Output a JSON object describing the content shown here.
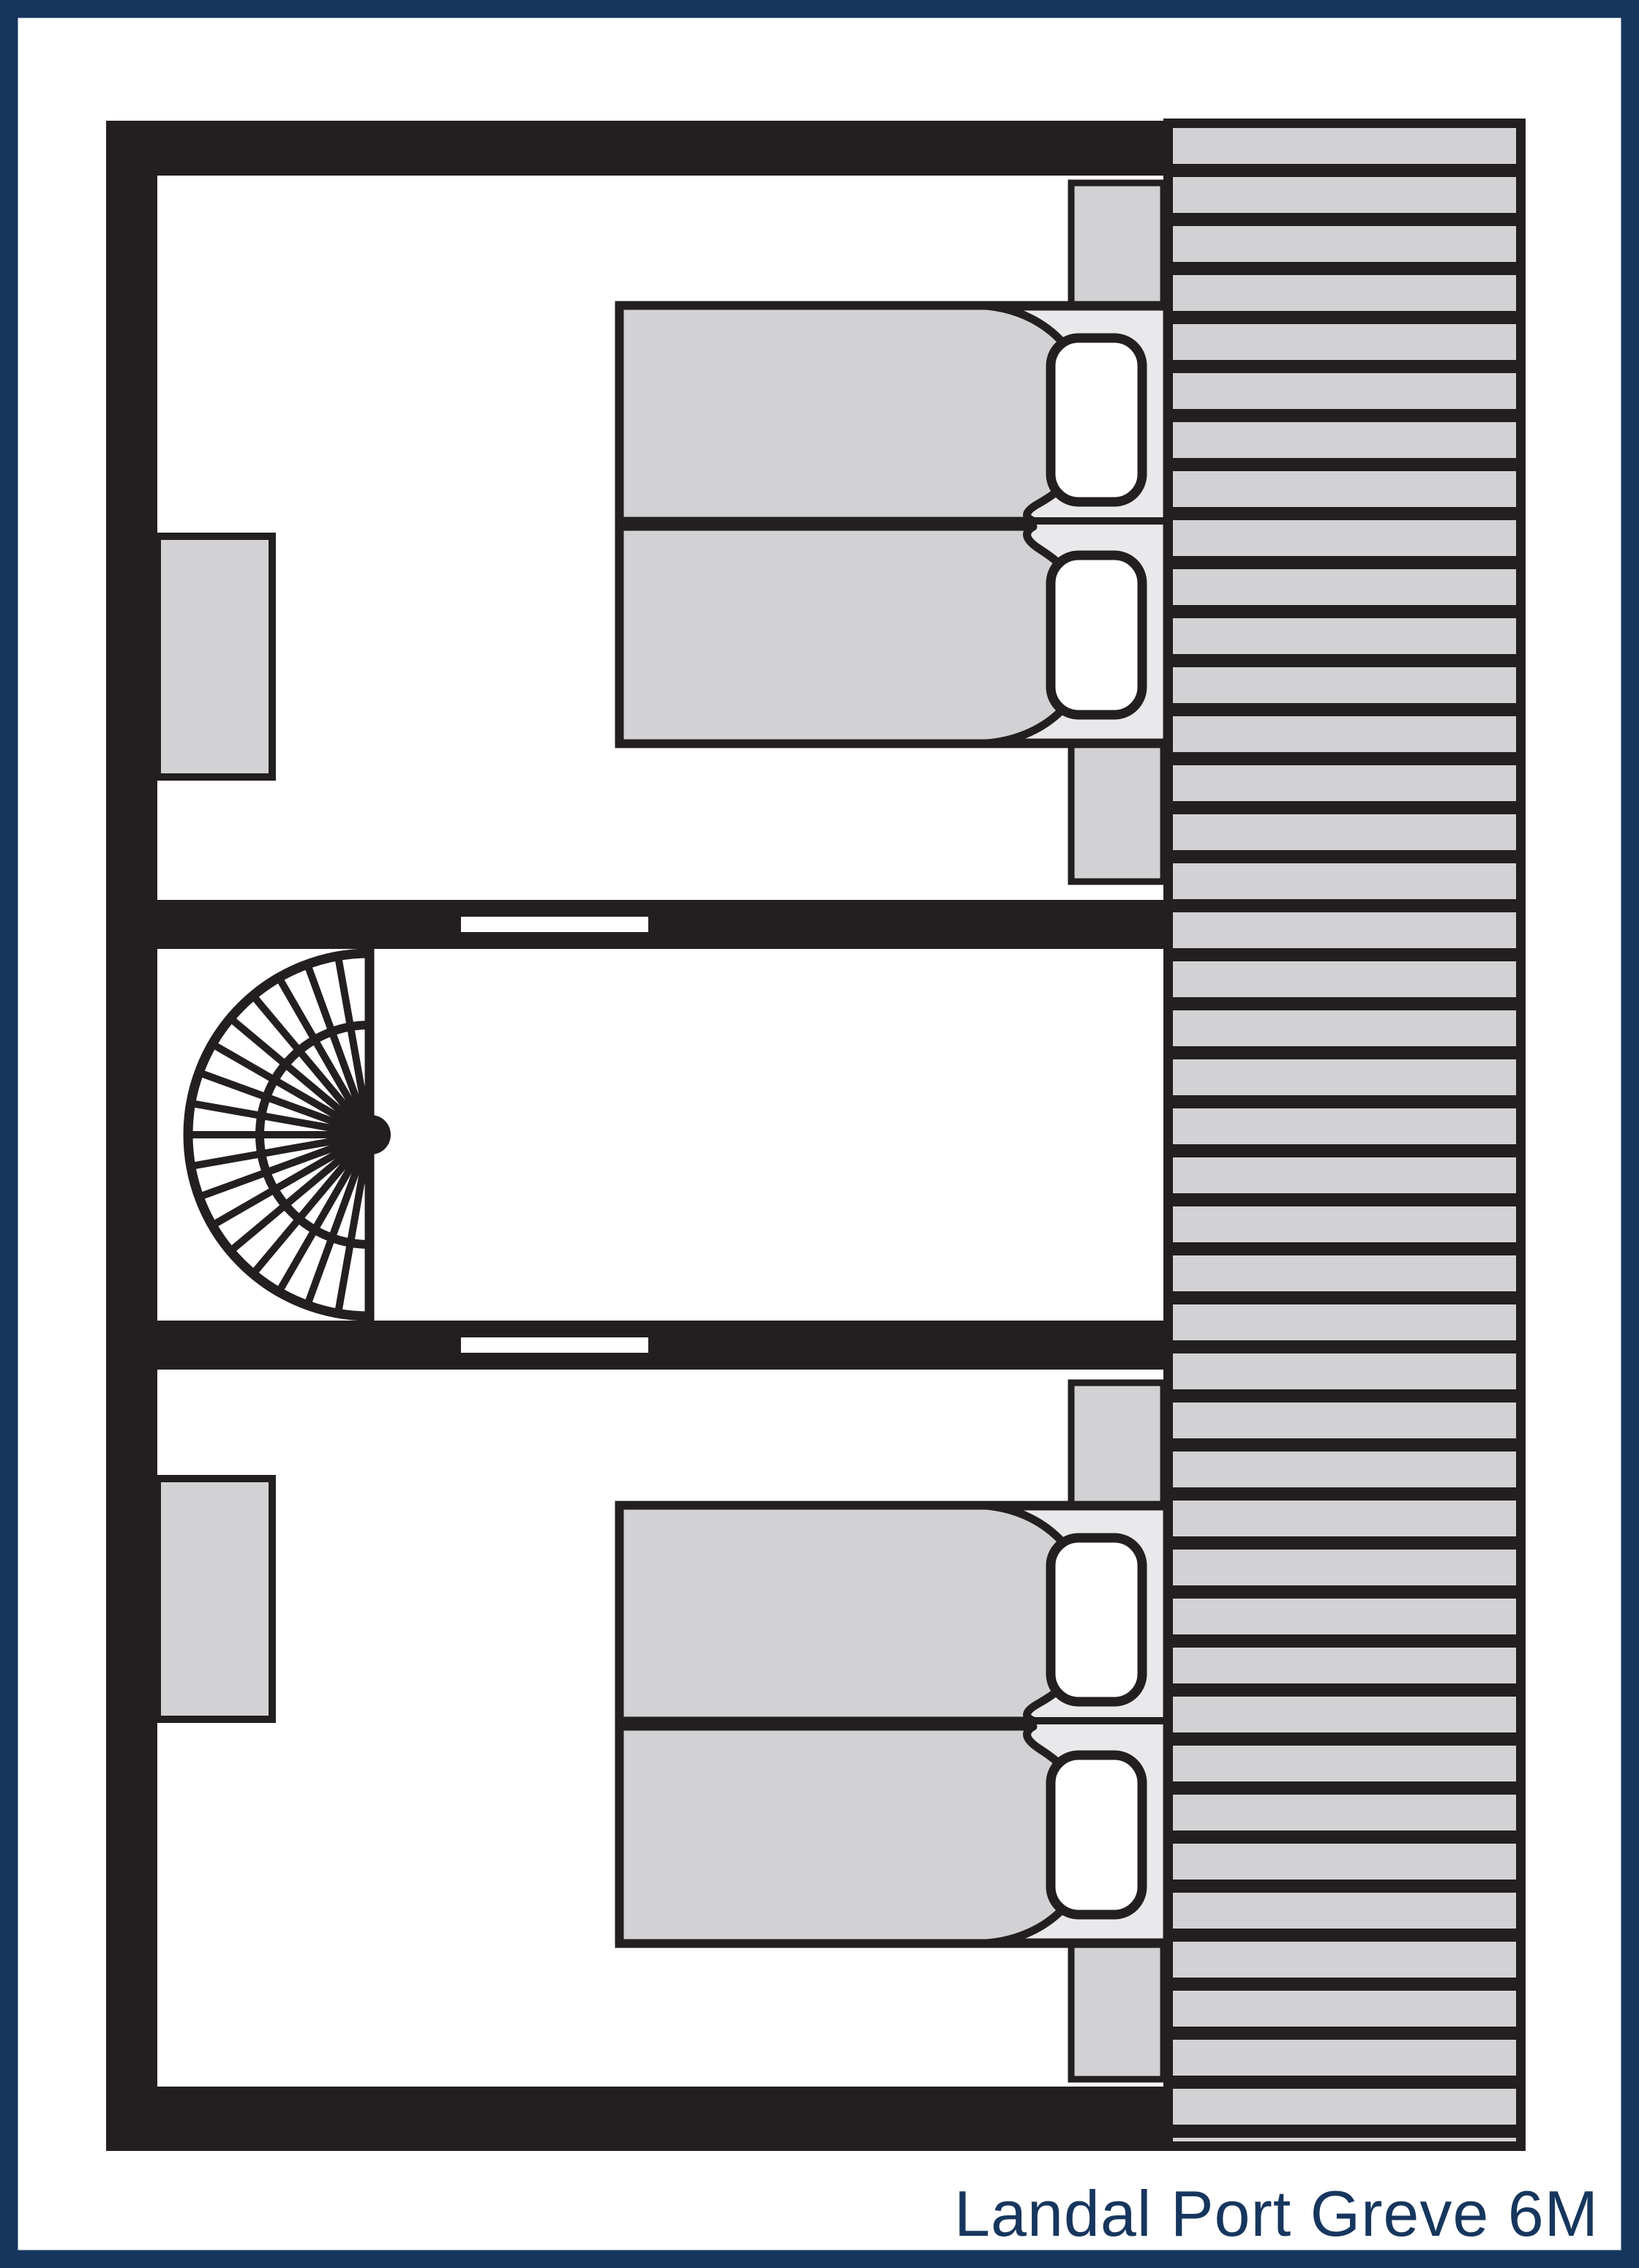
{
  "title": {
    "text": "Landal Port Greve 6M"
  },
  "colors": {
    "navy": "#16365d",
    "wall": "#231f20",
    "furniture_gray": "#d2d2d4",
    "bed_base": "#e9e9eb",
    "white": "#ffffff",
    "background": "#ffffff"
  },
  "floorplan": {
    "kind": "holiday-home floor plan, upper storey",
    "rooms": [
      {
        "id": "bedroom-top",
        "furniture": [
          "wardrobe",
          "double-bed",
          "duvet-left",
          "duvet-right",
          "pillow",
          "pillow",
          "nightstand",
          "nightstand"
        ]
      },
      {
        "id": "landing",
        "furniture": [
          "spiral-staircase"
        ],
        "doors": [
          "door-opening-to-top-bedroom",
          "door-opening-to-bottom-bedroom"
        ]
      },
      {
        "id": "bedroom-bottom",
        "furniture": [
          "wardrobe",
          "double-bed",
          "duvet-left",
          "duvet-right",
          "pillow",
          "pillow",
          "nightstand",
          "nightstand"
        ]
      }
    ],
    "deck": {
      "id": "roof-deck",
      "pattern": "horizontal-slats"
    }
  }
}
